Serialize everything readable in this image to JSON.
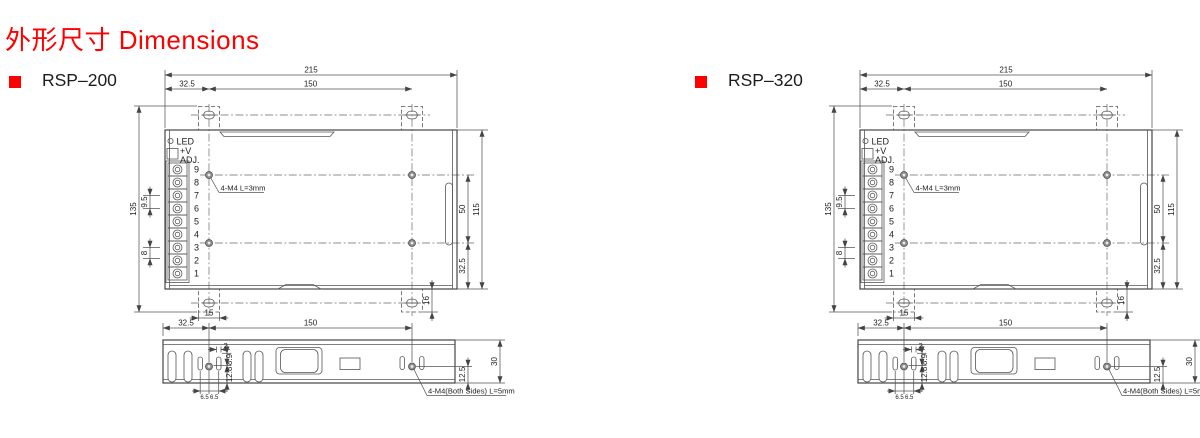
{
  "title": "外形尺寸 Dimensions",
  "accent_color": "#fe0000",
  "panels": [
    {
      "model": "RSP–200"
    },
    {
      "model": "RSP–320"
    }
  ],
  "drawing": {
    "top_view": {
      "dim_overall_width": "215",
      "dim_edge_to_hole": "32.5",
      "dim_hole_spacing": "150",
      "dim_overall_height": "135",
      "dim_body_depth": "115",
      "dim_hole_spacing_v": "50",
      "dim_hole_to_bottom": "32.5",
      "dim_tab_depth": "16",
      "dim_tab_width": "15",
      "dim_terminal_pitch": "9.5",
      "dim_terminal_pitch2": "8",
      "led_label": "LED",
      "adj_line1": "+V",
      "adj_line2": "ADJ.",
      "terminal_numbers": [
        "9",
        "8",
        "7",
        "6",
        "5",
        "4",
        "3",
        "2",
        "1"
      ],
      "mounting_note": "4-M4 L=3mm"
    },
    "side_view": {
      "dim_edge_to_hole": "32.5",
      "dim_hole_spacing": "150",
      "dim_height": "30",
      "dim_hole_to_bottom": "12.5",
      "dim_slot_gap": "2",
      "dim_a": "8.9",
      "dim_b": "12.8",
      "dim_left_offset": "6.5",
      "dim_right_offset": "6.5",
      "mounting_note": "4-M4(Both Sides) L=5mm"
    }
  }
}
